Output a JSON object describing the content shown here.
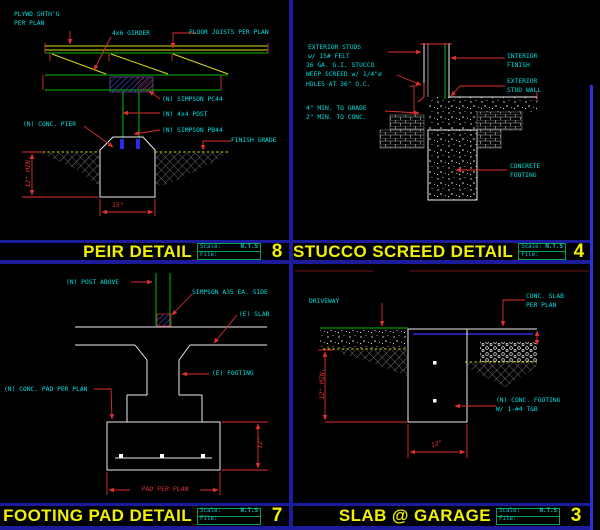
{
  "titlebar": {
    "scale_label": "Scale:",
    "scale_value": "N.T.S",
    "file_label": "File:"
  },
  "colors": {
    "background": "#000000",
    "divider": "#1b1b9c",
    "title_text": "#f0f000",
    "label_text": "#00dede",
    "dimension_red": "#e03131",
    "linework_white": "#ececec",
    "linework_green": "#00c000",
    "linework_yellow": "#d8d818",
    "linework_blue": "#2a2ae8",
    "border_blue": "#2e2ee0",
    "scalebox_border": "#00a35a"
  },
  "panels": {
    "pier": {
      "title": "PEIR DETAIL",
      "number": "8",
      "labels": {
        "plywood": "PLYWD SHTH'G\nPER PLAN",
        "girder": "4x6 GIRDER",
        "joists": "FLOOR JOISTS PER PLAN",
        "pc44": "(N) SIMPSON PC44",
        "post": "(N) 4x4 POST",
        "pb44": "(N) SIMPSON PB44",
        "pier": "(N) CONC. PIER",
        "grade": "FINISH GRADE",
        "dim_depth": "12\" MIN.",
        "dim_width": "15\""
      }
    },
    "stucco": {
      "title": "STUCCO SCREED DETAIL",
      "number": "4",
      "labels": {
        "studs": "EXTERIOR STUDS\nw/ 15# FELT",
        "screed": "26 GA. G.I. STUCCO\nWEEP SCREED w/ 1/4\"ø\nHOLES AT 36\" O.C.",
        "grade_clearance": "4\" MIN. TO GRADE\n2\" MIN. TO CONC.",
        "interior": "INTERIOR\nFINISH",
        "stud_wall": "EXTERIOR\nSTUD WALL",
        "footing": "CONCRETE\nFOOTING"
      }
    },
    "footing_pad": {
      "title": "FOOTING PAD DETAIL",
      "number": "7",
      "labels": {
        "post_above": "(N) POST ABOVE",
        "a35": "SIMPSON A35 EA. SIDE",
        "slab": "(E) SLAB",
        "footing": "(E) FOOTING",
        "pad": "(N) CONC. PAD PER PLAN",
        "dim_depth": "12\"",
        "dim_width": "PAD PER PLAN"
      }
    },
    "slab_garage": {
      "title": "SLAB @ GARAGE",
      "number": "3",
      "labels": {
        "driveway": "DRIVEWAY",
        "slab": "CONC. SLAB\nPER PLAN",
        "footing": "(N) CONC. FOOTING\nW/ 1-#4 T&B",
        "dim_depth": "12\" MIN.",
        "dim_width": "12\""
      }
    }
  }
}
